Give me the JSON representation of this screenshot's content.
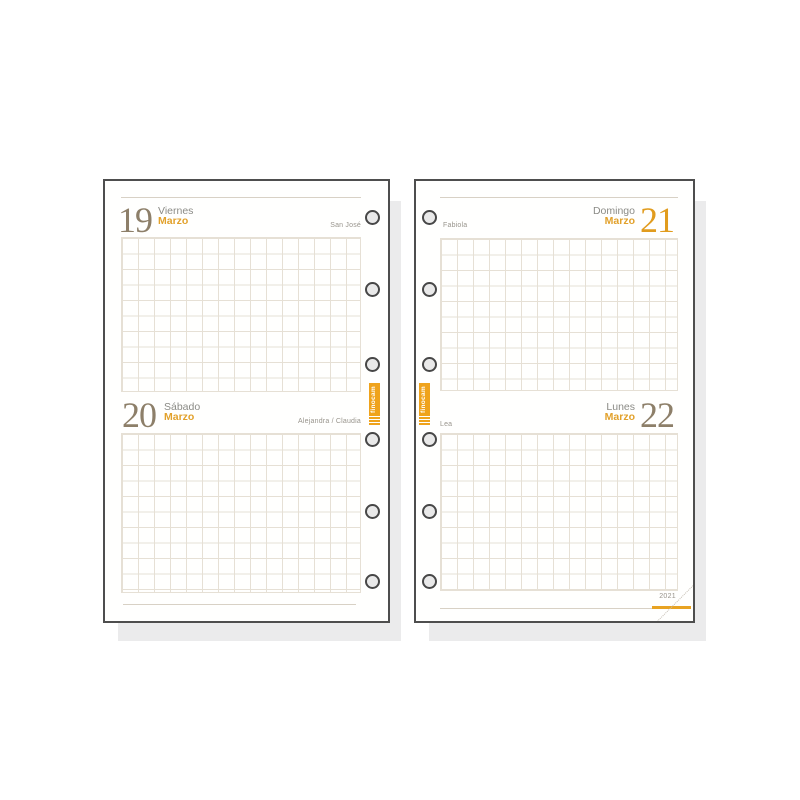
{
  "brand": {
    "logo_text": "finocam",
    "year_label": "2021"
  },
  "colors": {
    "accent_orange": "#E8A322",
    "day_number_taupe": "#8D7F69",
    "day_name_gray": "#8B8B86",
    "saint_gray": "#98948C",
    "grid_line": "#E6E0D5",
    "rule_line": "#D8D1C5",
    "page_border": "#4E4E4E",
    "shadow": "#EBEBEC"
  },
  "pages": {
    "left": {
      "sections": [
        {
          "day_number": "19",
          "day_name": "Viernes",
          "month": "Marzo",
          "saint": "San José"
        },
        {
          "day_number": "20",
          "day_name": "Sábado",
          "month": "Marzo",
          "saint": "Alejandra / Claudia"
        }
      ]
    },
    "right": {
      "sections": [
        {
          "day_number": "21",
          "day_name": "Domingo",
          "month": "Marzo",
          "saint": "Fabiola"
        },
        {
          "day_number": "22",
          "day_name": "Lunes",
          "month": "Marzo",
          "saint": "Lea"
        }
      ]
    }
  }
}
